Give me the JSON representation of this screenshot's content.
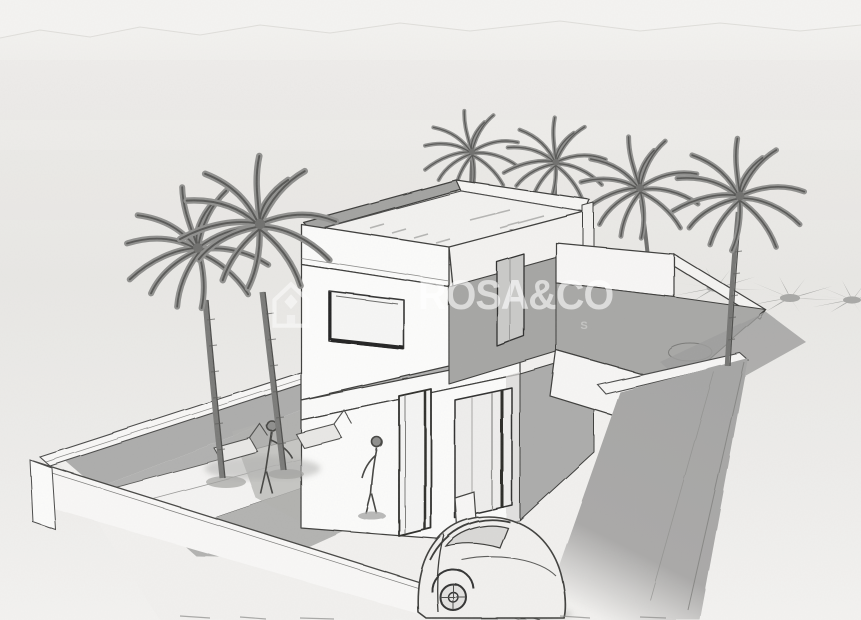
{
  "image_type": "architectural-concept-sketch",
  "watermark": {
    "brand": "ROSA&CO",
    "tagline_fragment": "S",
    "logo_icon": "house-outline-icon",
    "color": "#ffffff"
  },
  "scene": {
    "subject": "two-storey flat-roof villa with roof terrace, walled plot, pool, palm trees and car",
    "counts": {
      "palm_trees": 6,
      "palm_shadows": 3,
      "people_figures": 2,
      "sun_loungers": 2,
      "cars": 1
    },
    "elements": [
      "sky",
      "mountain-ridge",
      "perimeter-wall",
      "main-villa",
      "roof-parapet",
      "roof-deck",
      "upper-window",
      "entrance-door",
      "glass-slider",
      "side-wing-terrace",
      "pool",
      "terrace",
      "sun-loungers",
      "person-figure",
      "palm-tree",
      "palm-shadow",
      "street-shadow-band",
      "car-sketch",
      "gate-post",
      "watermark"
    ],
    "palette": {
      "paper": "#efeeec",
      "sky_light": "#f5f4f2",
      "shading_gray": "#a9a9a9",
      "wall_white": "#fbfbfa",
      "line_ink": "#3c3c3c",
      "watermark_white": "#ffffff"
    }
  }
}
